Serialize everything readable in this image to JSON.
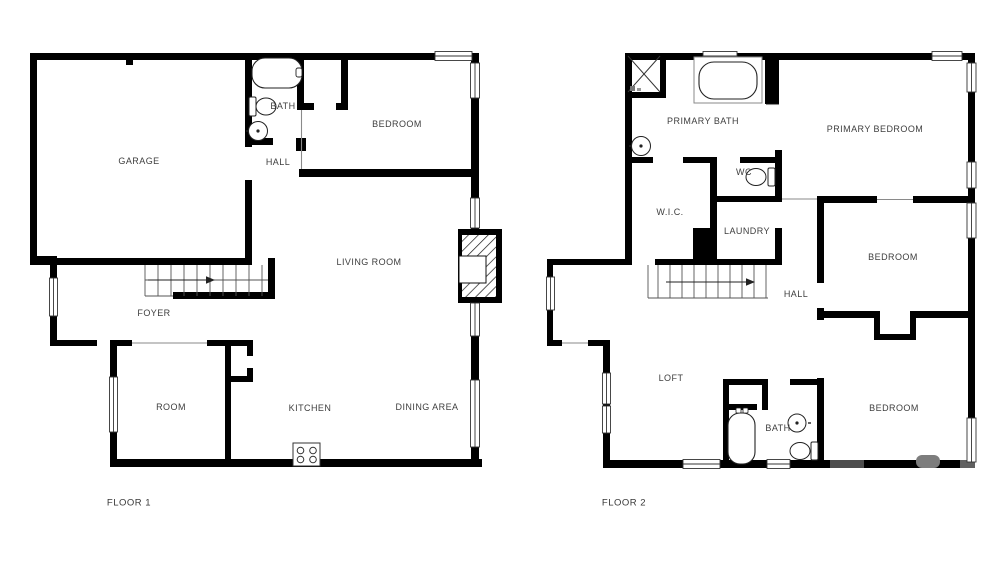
{
  "page": {
    "background": "#ffffff",
    "wall_color": "#000000",
    "label_color": "#3e3e3e"
  },
  "floor1": {
    "title": "FLOOR 1",
    "rooms": {
      "garage": "GARAGE",
      "bath": "BATH",
      "hall": "HALL",
      "bedroom": "BEDROOM",
      "living_room": "LIVING ROOM",
      "foyer": "FOYER",
      "room": "ROOM",
      "kitchen": "KITCHEN",
      "dining_area": "DINING AREA"
    },
    "fixtures": [
      "bathtub",
      "toilet",
      "sink",
      "stove",
      "fireplace",
      "stairs-up"
    ]
  },
  "floor2": {
    "title": "FLOOR 2",
    "rooms": {
      "primary_bath": "PRIMARY BATH",
      "primary_bedroom": "PRIMARY BEDROOM",
      "wc": "WC",
      "wic": "W.I.C.",
      "laundry": "LAUNDRY",
      "bedroom_mid": "BEDROOM",
      "hall": "HALL",
      "loft": "LOFT",
      "bath": "BATH",
      "bedroom_bottom": "BEDROOM"
    },
    "fixtures": [
      "shower",
      "bathtub",
      "sink",
      "toilet",
      "stairs-up"
    ]
  }
}
